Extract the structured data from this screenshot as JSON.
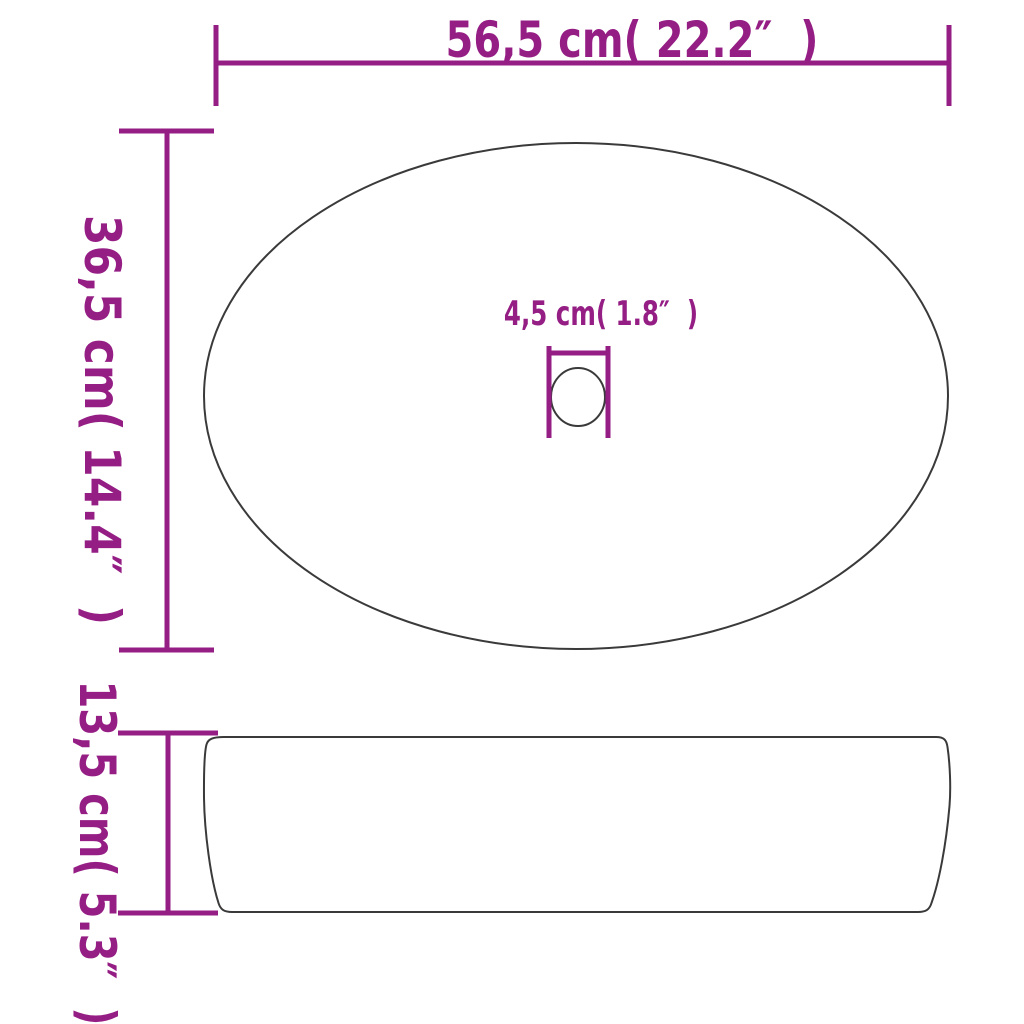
{
  "diagram": {
    "title": "washbasin-dimension-diagram",
    "labels": {
      "width": "56,5 cm( 22.2″  )",
      "depth": "36,5 cm( 14.4″  )",
      "drain": "4,5 cm( 1.8″  )",
      "height": "13,5 cm( 5.3″  )"
    },
    "colors": {
      "dimension": "#951E85",
      "outline": "#3A3A3A",
      "background": "#FFFFFF"
    }
  }
}
